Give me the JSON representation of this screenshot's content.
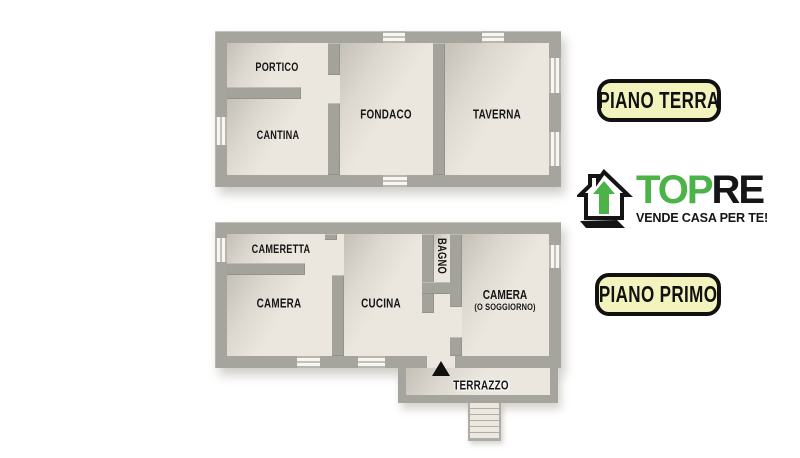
{
  "plans": {
    "terra": {
      "badge": "PIANO TERRA",
      "rooms": {
        "portico": "PORTICO",
        "cantina": "CANTINA",
        "fondaco": "FONDACO",
        "taverna": "TAVERNA"
      }
    },
    "primo": {
      "badge": "PIANO PRIMO",
      "rooms": {
        "cameretta": "CAMERETTA",
        "camera": "CAMERA",
        "cucina": "CUCINA",
        "bagno": "BAGNO",
        "camera2": "CAMERA",
        "camera2_sub": "(O SOGGIORNO)",
        "terrazzo": "TERRAZZO"
      }
    }
  },
  "logo": {
    "brand_green": "TOP",
    "brand_dark": "RE",
    "tagline": "VENDE CASA PER TE!",
    "icon": "house-arrow-up-icon"
  },
  "colors": {
    "wall": "#a6a59d",
    "floor": "#ebe7df",
    "badge_bg": "#f3f3bd",
    "badge_border": "#111111",
    "logo_green": "#4cb349",
    "text": "#161616",
    "background": "#ffffff"
  }
}
